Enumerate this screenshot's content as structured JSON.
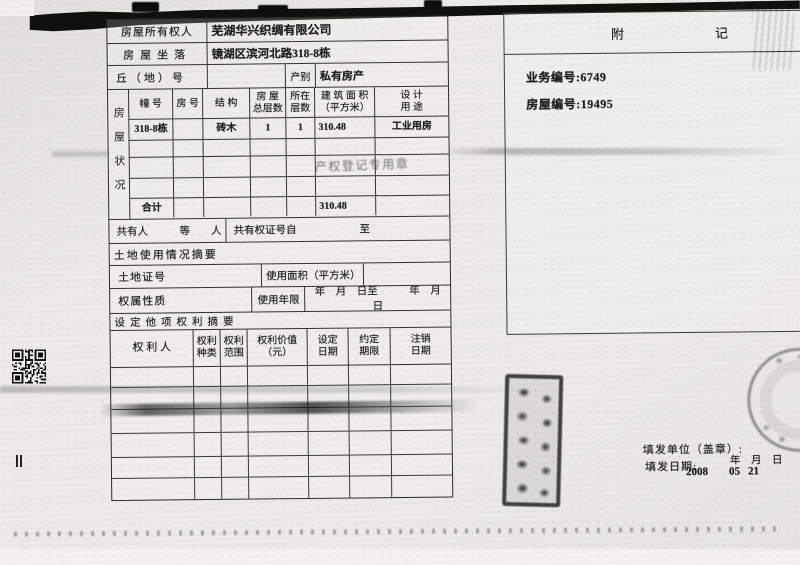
{
  "colors": {
    "paper": "#ecebe7",
    "ink": "#1b1b1b",
    "grid_line": "#333333",
    "faint_stamp": "#6a6a6a"
  },
  "form": {
    "owner": {
      "label": "房屋所有权人",
      "value": "芜湖华兴织绸有限公司"
    },
    "location": {
      "label": "房屋坐落",
      "value": "镜湖区滨河北路318-8栋"
    },
    "lot": {
      "label": "丘（地）号",
      "category_label": "产别",
      "category_value": "私有房产"
    },
    "house_status": {
      "side_label": "房屋状况",
      "columns": [
        {
          "l1": "幢 号",
          "l2": ""
        },
        {
          "l1": "房 号",
          "l2": ""
        },
        {
          "l1": "结 构",
          "l2": ""
        },
        {
          "l1": "房 屋",
          "l2": "总层数"
        },
        {
          "l1": "所在",
          "l2": "层数"
        },
        {
          "l1": "建 筑 面 积",
          "l2": "（平方米）"
        },
        {
          "l1": "设 计",
          "l2": "用 途"
        }
      ],
      "row1": {
        "building_no": "318-8栋",
        "room_no": "",
        "structure": "砖木",
        "total_floors": "1",
        "floor": "1",
        "area": "310.48",
        "designed_use": "工业用房"
      },
      "faint_stamp_text": "产权登记专用章",
      "total_label": "合计",
      "total_area": "310.48"
    },
    "co_owner": {
      "label": "共有人　　　等　　人",
      "cert_label": "共有权证号自　　　　　　至"
    },
    "land_title": "土地使用情况摘要",
    "land": {
      "cert_label": "土地证号",
      "area_label": "使用面积（平方米）",
      "nature_label": "权属性质",
      "years_label": "使用年限",
      "date_range": "年　月　日至　　　年　月　日"
    },
    "rights_title": "设定他项权利摘要",
    "rights_columns": [
      {
        "l1": "权  利  人",
        "l2": ""
      },
      {
        "l1": "权利",
        "l2": "种类"
      },
      {
        "l1": "权利",
        "l2": "范围"
      },
      {
        "l1": "权利价值",
        "l2": "（元）"
      },
      {
        "l1": "设定",
        "l2": "日期"
      },
      {
        "l1": "约定",
        "l2": "期限"
      },
      {
        "l1": "注销",
        "l2": "日期"
      }
    ]
  },
  "notes_panel": {
    "title": "附　　　　　　　记",
    "business_no": "业务编号:6749",
    "house_no": "房屋编号:19495"
  },
  "footer": {
    "issue_unit_label": "填发单位（盖章）:",
    "issue_date_label": "填发日期:",
    "ymd": "年　月　日",
    "year": "2008",
    "month": "05",
    "day": "21"
  }
}
